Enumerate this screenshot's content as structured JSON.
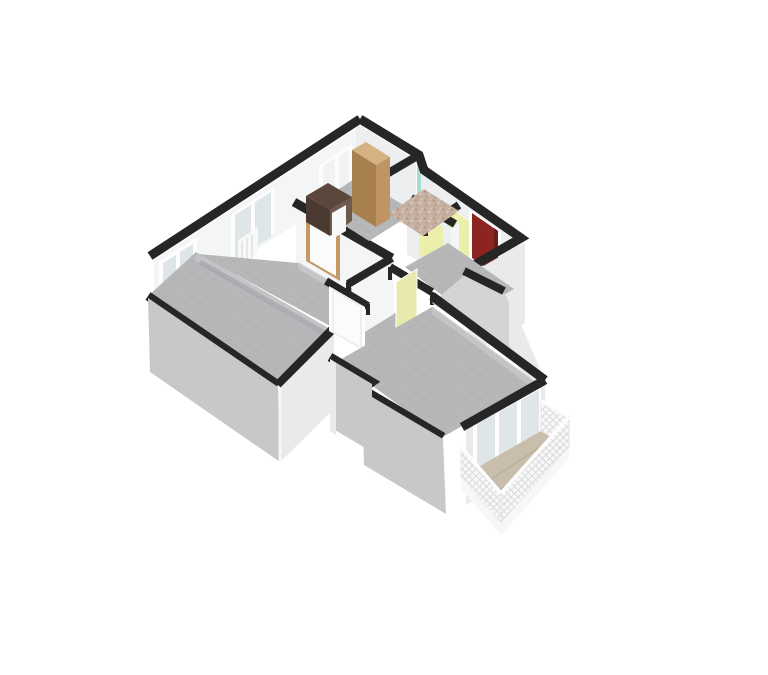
{
  "scene": {
    "kind": "3d-floor-plan-render",
    "canvas": {
      "width": 768,
      "height": 675
    },
    "background": "#ffffff"
  },
  "palette": {
    "wallTop": "#262626",
    "intWhite": "#f4f5f6",
    "intLight": "#eceef0",
    "intShade": "#d2d4d6",
    "extGray": "#c6c8ca",
    "extLight": "#e8eaeb",
    "frameWhite": "#fdfdfe",
    "glass": "#dfe6e7",
    "panel": "#f1f2f3",
    "floor": "#b6b7b9",
    "floorLight": "#c8c9cb",
    "floorDash": "#aaabad",
    "floorShadow": "#9b9da0",
    "mosaic": "#c6b0a1",
    "mosaicDot1": "#b2937f",
    "mosaicDot2": "#dbccbe",
    "teal": "#a9dcd1",
    "doorRed": "#8c2422",
    "doorRedDark": "#6f1b1a",
    "doorYellow": "#eceeab",
    "doorOpenYellow": "#e7eaac",
    "doorWhite": "#fbfbfb",
    "woodFrame": "#c39a66",
    "wardrobeFront": "#a8804f",
    "wardrobeSide": "#c09566",
    "wardrobeTop": "#d6b183",
    "deskTop": "#5c473d",
    "deskFront": "#4a3a32",
    "deskSide": "#6e594d",
    "radiator": "#f7f8f8",
    "balconyFloor": "#c9beac",
    "balconyLine": "#b4a894",
    "latticeBg": "#f8f8f8",
    "lattice": "#dcdcdc",
    "slabEdge": "#f6f7f7"
  },
  "structure": {
    "rooms": [
      {
        "id": "hall-top",
        "features": [
          "wardrobe",
          "desk",
          "glazed-facade-door",
          "wood-frame-door"
        ]
      },
      {
        "id": "bathroom",
        "features": [
          "mosaic-floor",
          "teal-accent-wall"
        ]
      },
      {
        "id": "entrance-corridor",
        "features": [
          "entrance-door-red",
          "interior-door-yellow-1",
          "interior-door-yellow-2"
        ]
      },
      {
        "id": "bedroom",
        "features": [
          "window",
          "radiator"
        ]
      },
      {
        "id": "room-left",
        "features": [
          "window",
          "white-door"
        ]
      },
      {
        "id": "living-room",
        "features": [
          "open-door-yellow-green",
          "balcony-window-3-pane"
        ]
      },
      {
        "id": "balcony",
        "features": [
          "lattice-railing",
          "plank-floor"
        ]
      }
    ]
  }
}
